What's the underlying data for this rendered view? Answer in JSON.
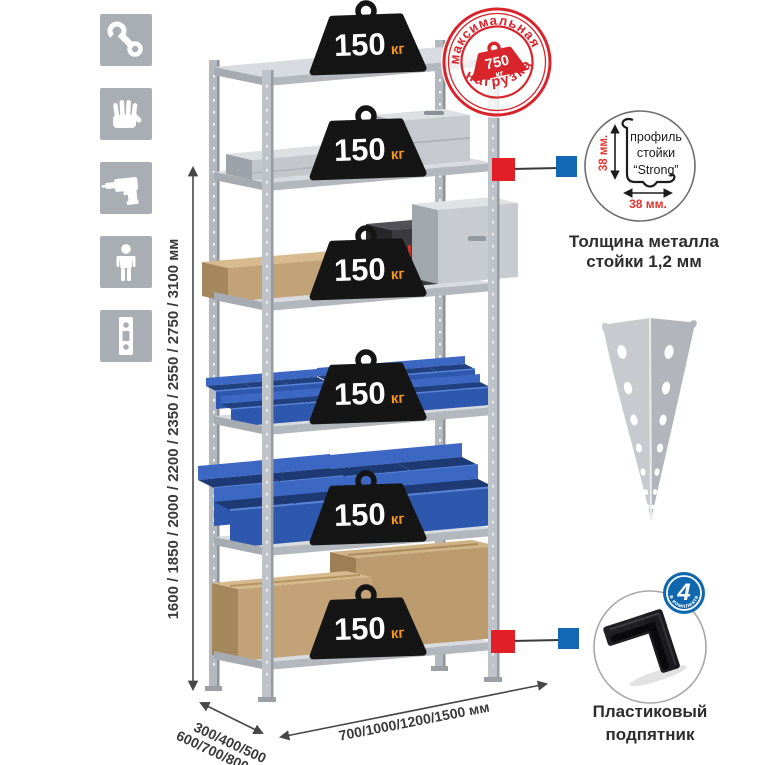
{
  "assembly_icons": {
    "items": [
      {
        "name": "wrench-icon"
      },
      {
        "name": "work-gloves-icon"
      },
      {
        "name": "drill-icon"
      },
      {
        "name": "person-height-icon"
      },
      {
        "name": "perforated-profile-icon"
      }
    ]
  },
  "weights": {
    "value": "150",
    "unit": "кг",
    "count": 6
  },
  "max_load_stamp": {
    "arc_top": "максимальная",
    "arc_bottom": "нагрузка",
    "value": "750",
    "unit": "кг"
  },
  "dimensions": {
    "height_label": "1600 / 1850 / 2000 / 2200 / 2350 / 2550 / 2750 / 3100 мм",
    "depth_label_line1": "300/400/500",
    "depth_label_line2": "600/700/800 мм",
    "width_label": "700/1000/1200/1500 мм"
  },
  "profile_detail": {
    "title_line1": "профиль",
    "title_line2": "стойки",
    "title_line3": "“Strong”",
    "dim_vertical": "38 мм.",
    "dim_horizontal": "38 мм.",
    "caption_line1": "Толщина металла",
    "caption_line2": "стойки 1,2 мм"
  },
  "foot_detail": {
    "badge_value": "4",
    "badge_text": "в комплекте",
    "caption_line1": "Пластиковый",
    "caption_line2": "подпятник"
  },
  "colors": {
    "stamp_red": "#d8252b",
    "weight_black": "#151515",
    "unit_orange": "#f7941d",
    "bin_blue": "#2e57ae",
    "metal_light": "#d8dbdf",
    "metal_mid": "#b4b9bf",
    "icon_gray": "#a9aeb4",
    "marker_red": "#e01f26",
    "marker_blue": "#1268b3",
    "cardboard": "#c2a276"
  }
}
